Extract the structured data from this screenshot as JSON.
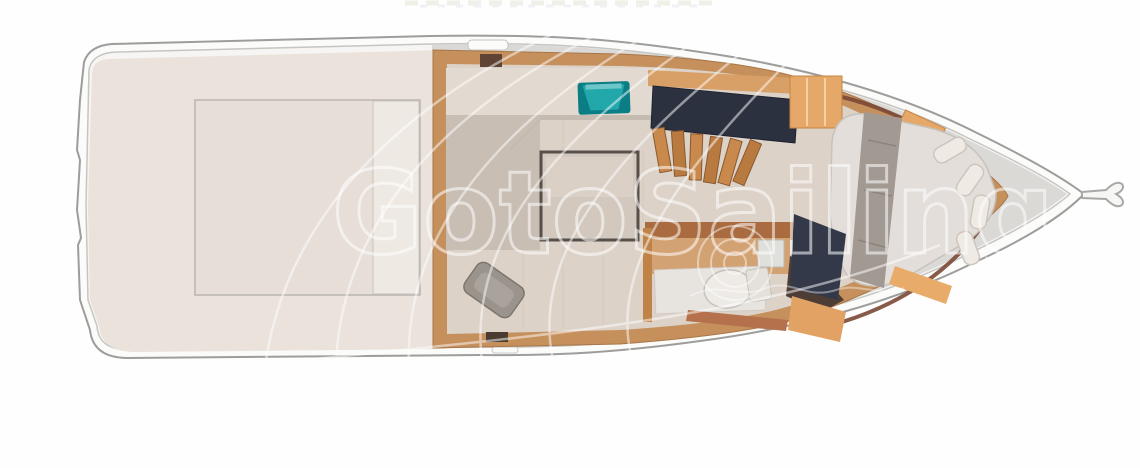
{
  "watermark": {
    "text": "GotoSailing",
    "color": "#ffffff",
    "opacity": 0.55
  },
  "plan": {
    "subject": "yacht-deck-floorplan",
    "orientation": "bow-right"
  },
  "palette": {
    "hull_stroke": "#9d9d9b",
    "deck_fill": "#f6f5f3",
    "cockpit_floor": "#eae2db",
    "hatch_fill": "#e6ded7",
    "hatch_walkway": "#efe9e3",
    "side_deck": "#dbd9d6",
    "wood_trim": "#c6905c",
    "salon_floor": "#dcd2c8",
    "counter": "#e2dad1",
    "counter_shadow": "#b3a79c",
    "sink_teal": "#22a7ab",
    "sink_teal_dark": "#0b7e85",
    "cabinet_navy": "#2c3140",
    "stair_wood": "#c28147",
    "table_top": "#d2c8be",
    "table_border": "#57504a",
    "pillow_gray": "#9b948c",
    "bathroom_wood": "#d3a273",
    "toilet_white": "#eeebe7",
    "copper": "#b5714b",
    "shelf_tan": "#e5a869",
    "mattress": "#e4deda",
    "blanket_gray": "#a29a92",
    "footboard_navy": "#333949",
    "bow_trim_brown": "#7a4836"
  }
}
